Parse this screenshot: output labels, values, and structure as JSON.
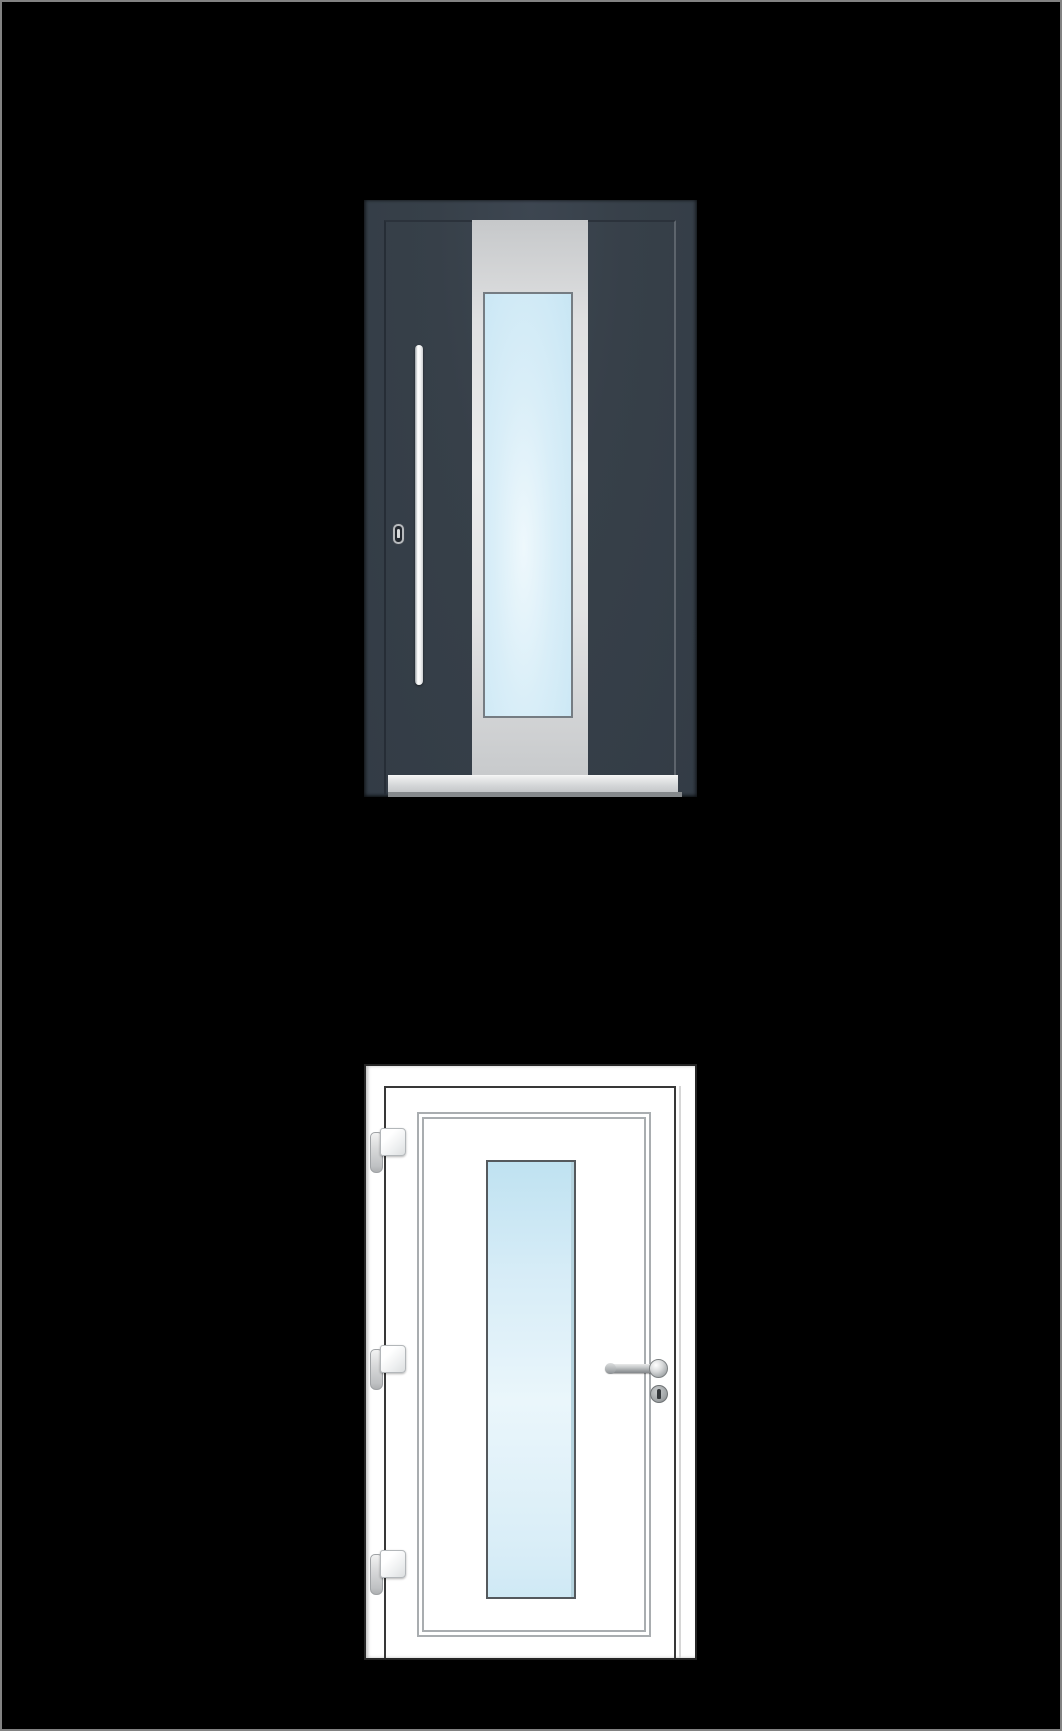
{
  "page": {
    "description": "black catalogue page showing two entry-door product renderings stacked vertically"
  },
  "colors": {
    "page_bg": "#000000",
    "page_border": "#828282",
    "anthracite": "#374049",
    "anthracite_edge_dark": "#262d36",
    "anthracite_edge_light": "#5d646c",
    "panel_gray_light": "#ebecec",
    "panel_gray_dark": "#c6c8ca",
    "glass_blue": "#c8e6f4",
    "glass_blue_light": "#eef8fc",
    "glass_border_top": "#757c82",
    "glass_border_dark": "#54595d",
    "white_door": "#ffffff",
    "white_door_border": "#262626",
    "leaf_line": "#383838",
    "deco_line": "#a9adb0",
    "metal_light": "#e9eaea",
    "metal_dark": "#83878a",
    "sill_light": "#f0f1f1",
    "sill_dark": "#c3c6c8",
    "sill_under": "#85898c",
    "handle_white": "#ffffff",
    "hinge_border": "#b3b7ba"
  },
  "doors": {
    "top": {
      "style": "anthracite entry door",
      "elements": [
        "door leaf outline",
        "light-gray glazing panel strip",
        "tall frosted glass pane",
        "vertical bar pull handle",
        "keyhole",
        "threshold sill"
      ]
    },
    "bottom": {
      "style": "white entry door",
      "elements": [
        "door leaf outline",
        "double decorative trim lines",
        "tall frosted glass pane",
        "three hinges",
        "lever handle with round rose",
        "lock cylinder"
      ]
    }
  }
}
